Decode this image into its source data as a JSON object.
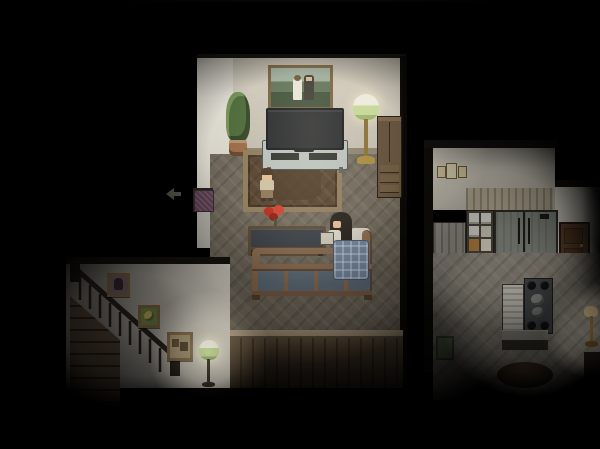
{
  "meta": {
    "scene_label": "Top-down pixel-art RPG house interior at night, dark vignette with lamp-lit bedroom, staircase hall and kitchen",
    "hud_text": "",
    "light_sources": [
      "bedroom-floor-lamp",
      "stairwell-green-lamp",
      "kitchen-ambient"
    ]
  },
  "colors": {
    "void": "#000000",
    "bedroom_wall": "#d3cdbf",
    "bedroom_wall_white": "#e6e3d8",
    "bedroom_floor": "#6f675a",
    "panel_trim": "#b3a084",
    "rug_border": "#8f7b5c",
    "rug_inner": "#55422e",
    "tv_screen": "#24272b",
    "tv_cabinet": "#b9c2bd",
    "lamp_gold": "#a98b3f",
    "lamp_shade": "#e9e7da",
    "lamp_shade_green": "#c8dc9c",
    "plant_green": "#4d6b3a",
    "plant_pot": "#9c6b45",
    "picture_frame": "#77603f",
    "dresser": "#64503a",
    "bed_frame": "#8a6a4e",
    "bed_panel": "#5f6c77",
    "blanket": "#74869e",
    "skin": "#e3bd94",
    "boy_hair": "#4a3424",
    "boy_shirt": "#cdc2a6",
    "boy_pants": "#8d7758",
    "girl_hair": "#26201c",
    "girl_shirt": "#ded9cc",
    "book": "#cfcabb",
    "flowers": "#b62a1c",
    "doormat": "#5f4152",
    "stair_wall": "#d8d3c7",
    "stair_wood": "#524435",
    "rail": "#261f19",
    "stair_lamp_green": "#b9cf8e",
    "kitchen_wall": "#c9c4b7",
    "kitchen_wall_right": "#dcd8cc",
    "kitchen_floor": "#8d877b",
    "fridge": "#82867d",
    "kitchen_door": "#5c412e",
    "counter": "#9a958a",
    "stove": "#46484a",
    "shelf_plate": "#d8d6cd",
    "glow_warm": "#fff3cf"
  },
  "bedroom": {
    "label": "Bedroom",
    "objects": {
      "wall_picture": {
        "label": "Framed wedding painting (couple with mountains)"
      },
      "plant": {
        "label": "Potted plant"
      },
      "tv": {
        "label": "Flat-screen TV"
      },
      "tv_cabinet": {
        "label": "TV cabinet with media slots"
      },
      "floor_lamp": {
        "label": "Lit floor lamp with green-banded shade"
      },
      "dresser": {
        "label": "Tall wooden dresser"
      },
      "rug": {
        "label": "Brown area rug"
      },
      "flowers": {
        "label": "Red flowers in vase"
      },
      "table": {
        "label": "Low dark-top table"
      },
      "bed": {
        "label": "Metal-frame double bed"
      },
      "pillow": {
        "label": "Pillow"
      },
      "blanket": {
        "label": "Blue plaid blanket"
      },
      "doorway": {
        "label": "West doorway with purple doormat"
      },
      "exit_arrow": {
        "label": "Faint west exit arrow indicator"
      }
    },
    "characters": {
      "boy": {
        "label": "Boy standing beside the rug"
      },
      "girl": {
        "label": "Girl sitting up in bed holding a book"
      }
    }
  },
  "stairwell": {
    "label": "Staircase hall",
    "objects": {
      "stairs": {
        "label": "Wooden staircase descending with dark railing"
      },
      "picture_1": {
        "label": "Small framed portrait"
      },
      "picture_2": {
        "label": "Small framed flower picture"
      },
      "picture_3": {
        "label": "Small framed photo collage"
      },
      "floor_lamp": {
        "label": "Lit green-shade floor lamp"
      }
    }
  },
  "kitchen": {
    "label": "Kitchen",
    "objects": {
      "wall_frames": {
        "label": "Small framed certificates on wall"
      },
      "upper_cabinets": {
        "label": "Slatted upper cabinets"
      },
      "dish_shelf": {
        "label": "Shelf stacked with dishes"
      },
      "fridge": {
        "label": "Large refrigerator"
      },
      "door": {
        "label": "Brown wooden door"
      },
      "side_counter": {
        "label": "Counter side panel"
      },
      "cabinet": {
        "label": "White lower cabinet"
      },
      "stove": {
        "label": "Stove top with four burners and pots"
      },
      "counter": {
        "label": "Kitchen counter"
      },
      "green_frame": {
        "label": "Small green-framed picture"
      },
      "table": {
        "label": "Round wooden dining table"
      },
      "floor_lamp": {
        "label": "Gold floor lamp"
      }
    }
  }
}
